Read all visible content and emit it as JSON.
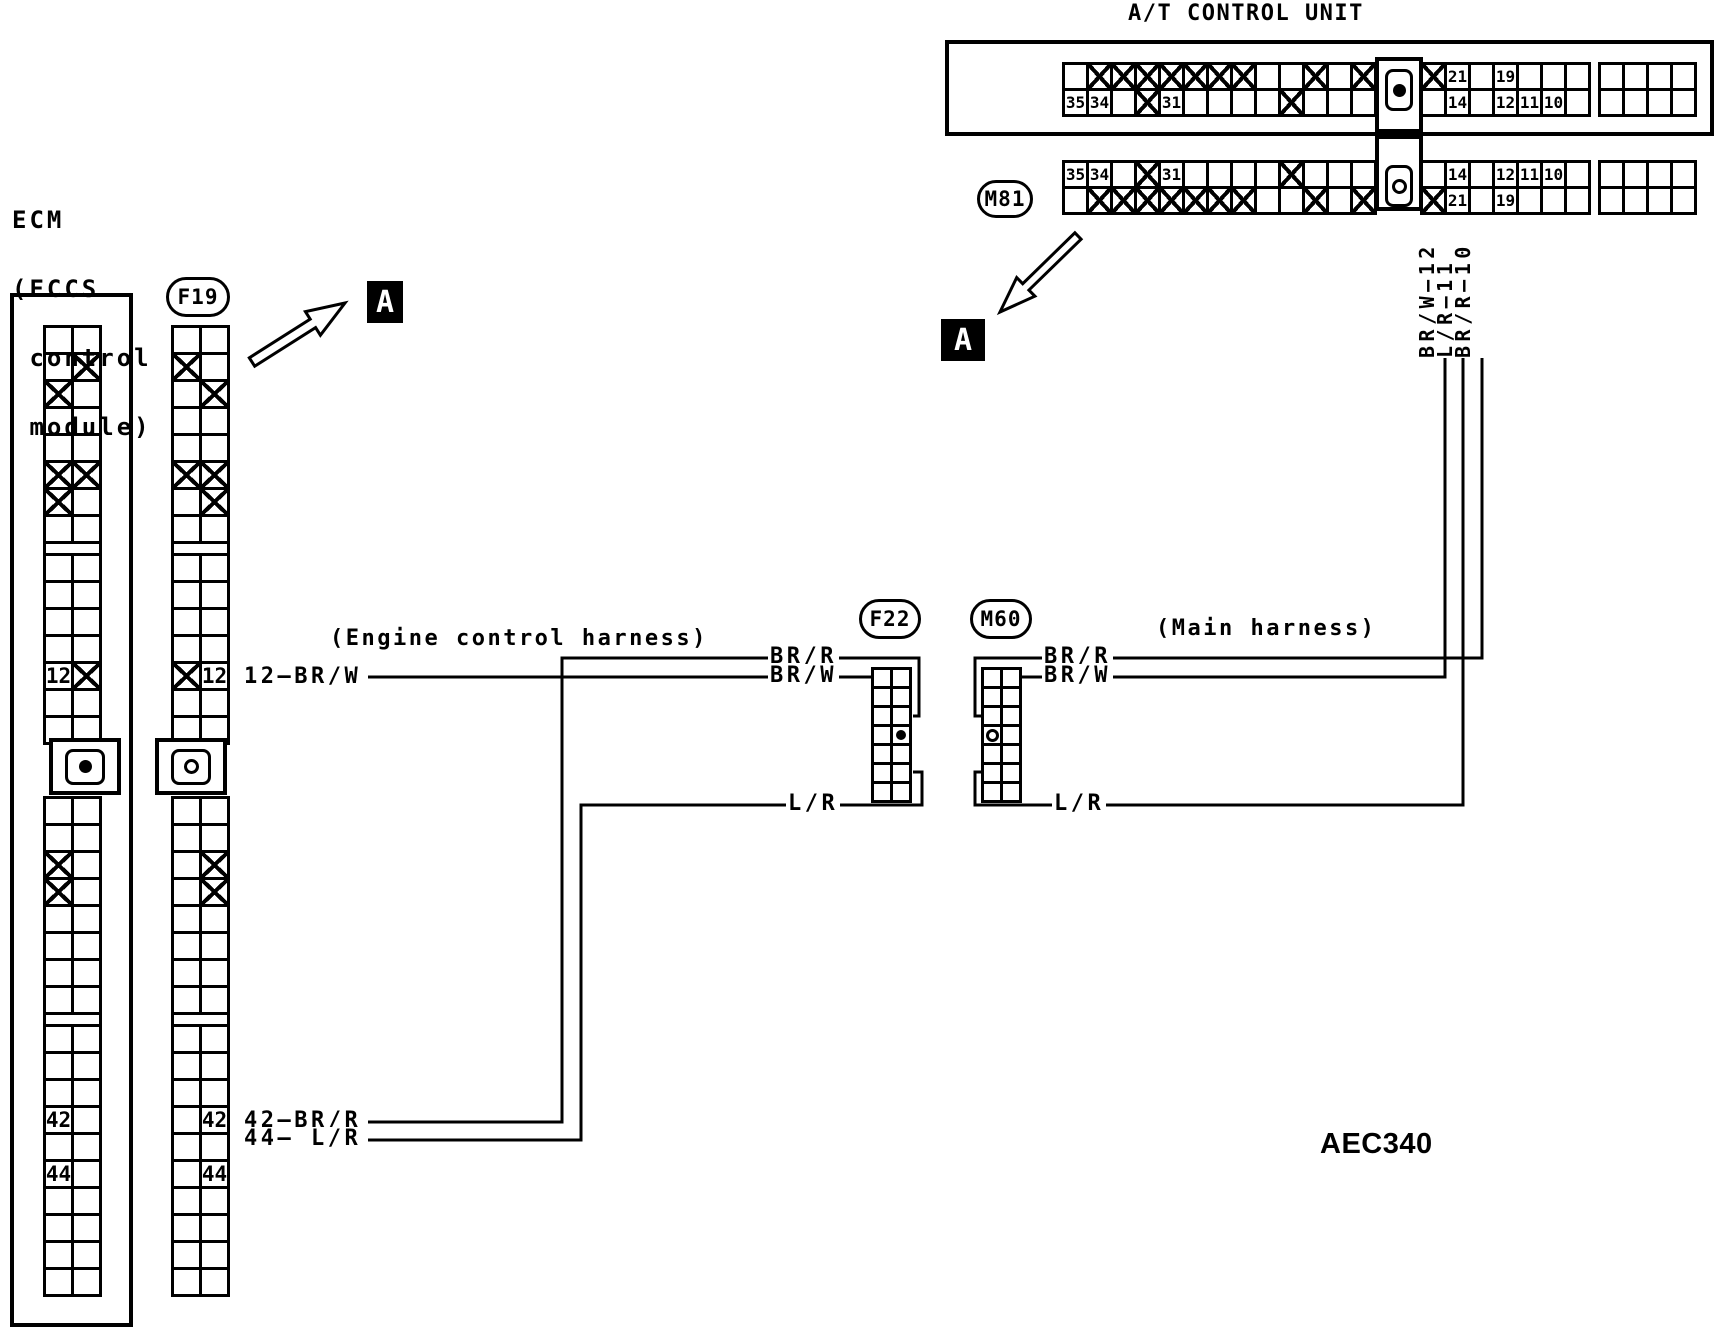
{
  "title": "A/T CONTROL UNIT",
  "diagram_code": "AEC340",
  "section_marker": "A",
  "ecm": {
    "line1": "ECM",
    "line2": "(ECCS",
    "line3": " control",
    "line4": " module)"
  },
  "ovals": {
    "f19": "F19",
    "m81": "M81",
    "f22": "F22",
    "m60": "M60"
  },
  "harness": {
    "engine": "(Engine control harness)",
    "main": "(Main harness)"
  },
  "wires": {
    "ecm_pin12": "12—BR/W",
    "ecm_pin42": "42—BR/R",
    "ecm_pin44": "44— L/R",
    "f22_brr": "BR/R",
    "f22_brw": "BR/W",
    "f22_lr": "L/R",
    "m60_brr": "BR/R",
    "m60_brw": "BR/W",
    "m60_lr": "L/R",
    "at_pin12": "BR/W—12",
    "at_pin11": "L/R—11",
    "at_pin10": "BR/R—10"
  },
  "at_connector": {
    "x_row": [
      "",
      "X",
      "X",
      "X",
      "X",
      "X",
      "X",
      "X",
      "",
      "",
      "X",
      "",
      "X",
      "KEY",
      "X",
      "21",
      "",
      "19",
      "",
      "",
      "",
      "DIV",
      "",
      "",
      "",
      ""
    ],
    "num_row": [
      "35",
      "34",
      "",
      "X",
      "31",
      "",
      "",
      "",
      "",
      "X",
      "",
      "",
      "",
      "KEY",
      "",
      "14",
      "",
      "12",
      "11",
      "10",
      "",
      "DIV",
      "",
      "",
      "",
      ""
    ],
    "key_top": "dot",
    "key_m81": "circle"
  },
  "strips": {
    "ecm": [
      [
        "",
        ""
      ],
      [
        "",
        "X"
      ],
      [
        "X",
        ""
      ],
      [
        "",
        ""
      ],
      [
        "",
        ""
      ],
      [
        "X",
        "X"
      ],
      [
        "X",
        ""
      ],
      [
        "",
        ""
      ],
      "SEP",
      [
        "",
        ""
      ],
      [
        "",
        ""
      ],
      [
        "",
        ""
      ],
      [
        "",
        ""
      ],
      [
        "12",
        "X"
      ],
      [
        "",
        ""
      ],
      [
        "",
        ""
      ],
      "KEY",
      [
        "",
        ""
      ],
      [
        "",
        ""
      ],
      [
        "X",
        ""
      ],
      [
        "X",
        ""
      ],
      [
        "",
        ""
      ],
      [
        "",
        ""
      ],
      [
        "",
        ""
      ],
      [
        "",
        ""
      ],
      "SEP",
      [
        "",
        ""
      ],
      [
        "",
        ""
      ],
      [
        "",
        ""
      ],
      [
        "42",
        ""
      ],
      [
        "",
        ""
      ],
      [
        "44",
        ""
      ],
      [
        "",
        ""
      ],
      [
        "",
        ""
      ],
      [
        "",
        ""
      ],
      [
        "",
        ""
      ]
    ],
    "ecm_key": "dot",
    "f19": [
      [
        "",
        ""
      ],
      [
        "X",
        ""
      ],
      [
        "",
        "X"
      ],
      [
        "",
        ""
      ],
      [
        "",
        ""
      ],
      [
        "X",
        "X"
      ],
      [
        "",
        "X"
      ],
      [
        "",
        ""
      ],
      "SEP",
      [
        "",
        ""
      ],
      [
        "",
        ""
      ],
      [
        "",
        ""
      ],
      [
        "",
        ""
      ],
      [
        "X",
        "12"
      ],
      [
        "",
        ""
      ],
      [
        "",
        ""
      ],
      "KEY",
      [
        "",
        ""
      ],
      [
        "",
        ""
      ],
      [
        "",
        "X"
      ],
      [
        "",
        "X"
      ],
      [
        "",
        ""
      ],
      [
        "",
        ""
      ],
      [
        "",
        ""
      ],
      [
        "",
        ""
      ],
      "SEP",
      [
        "",
        ""
      ],
      [
        "",
        ""
      ],
      [
        "",
        ""
      ],
      [
        "",
        "42"
      ],
      [
        "",
        ""
      ],
      [
        "",
        "44"
      ],
      [
        "",
        ""
      ],
      [
        "",
        ""
      ],
      [
        "",
        ""
      ],
      [
        "",
        ""
      ]
    ],
    "f19_key": "circle"
  },
  "small_connectors": {
    "f22": {
      "rows": 7,
      "cols": 2,
      "marker_row": 3,
      "marker_col": 1,
      "marker": "dot"
    },
    "m60": {
      "rows": 7,
      "cols": 2,
      "marker_row": 3,
      "marker_col": 0,
      "marker": "circle"
    }
  },
  "colors": {
    "ink": "#000000",
    "paper": "#ffffff"
  }
}
